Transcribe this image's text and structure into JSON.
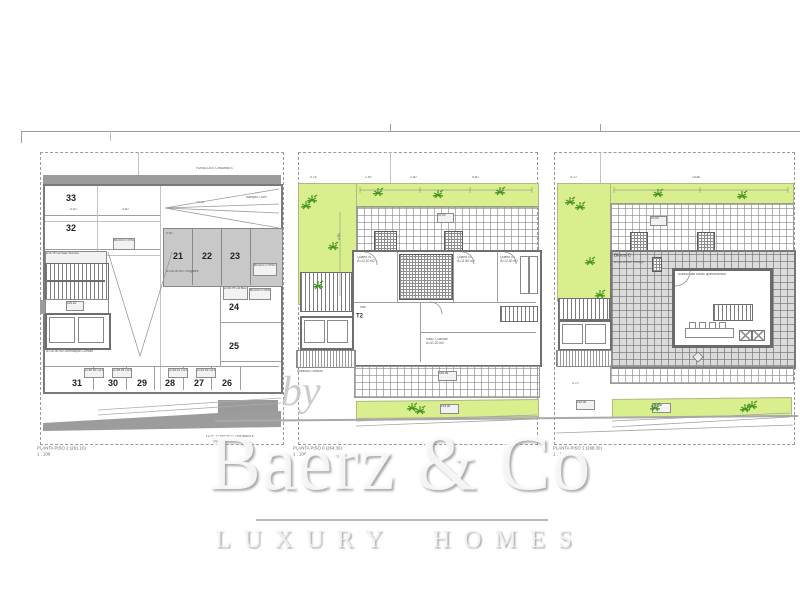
{
  "brand": {
    "by": "by",
    "name": "Baerz & Co",
    "tagline": "LUXURY HOMES"
  },
  "colors": {
    "green": "#d9ee8d",
    "plant": "#4a9426",
    "wall": "#6f6f6f",
    "paving": "#c8c8c8"
  },
  "plans": {
    "garage": {
      "title": "PLANTA PISO 2 (261.10)",
      "scale": "1 : 100",
      "top_note": "FURACOES CHAMINES",
      "confinante_note": "LOTE TERRENO CONFINANTE",
      "ramp_note": "Rampa i=15%",
      "left_spaces": [
        "33",
        "32"
      ],
      "center_spaces": [
        "21",
        "22",
        "23"
      ],
      "right_spaces": [
        "24",
        "25"
      ],
      "bottom_spaces": [
        "31",
        "30",
        "29",
        "28",
        "27",
        "26"
      ],
      "block_note": "A=28.00 m2  4 lugares",
      "core": {
        "sala": "A=4.75 m2 Sala Técnica",
        "nivel": "100.10",
        "arrumos": "A=16.90 m2 Arrumação Comum"
      },
      "unit_boxes": [
        "BLOCO C PISO 2",
        "BLOCO C PISO 3",
        "A=32.75 m2 Box 1",
        "BLOCO C PISO 4",
        "A=30.50 m2 Box 6",
        "A=28.05 m2 Box 5",
        "A=26.10 m2 Box 4",
        "A=24.30 m2 Box 3"
      ],
      "dims": [
        "5.40",
        "3.60",
        "30.05",
        "4.90"
      ]
    },
    "floor": {
      "title": "PLANTA PISO 0 (264.30)",
      "scale": "1 : 100",
      "unit": "T2",
      "rooms": [
        "Quarto 01",
        "Quarto 02",
        "Quarto 03",
        "Sala / Cozinha",
        "I.S.",
        "Hall"
      ],
      "areas": [
        "A=12.10 m2",
        "A=11.80 m2",
        "A=12.40 m2",
        "A=41.20 m2"
      ],
      "core_note": "Acessos Comuns",
      "dims": [
        "4.75",
        "1.90",
        "2.50",
        "5.60",
        "10.00",
        "160.00",
        "4.50"
      ]
    },
    "roof": {
      "title": "PLANTA PISO 1 (268.30)",
      "scale": "1 : 100",
      "bloco": "Bloco C",
      "bloco_sub": "A=28.20 m2 Terraço",
      "room_note": "Acesso das zonas apartamentos",
      "dims": [
        "4.70",
        "15.80",
        "160.00",
        "10.00"
      ]
    }
  }
}
